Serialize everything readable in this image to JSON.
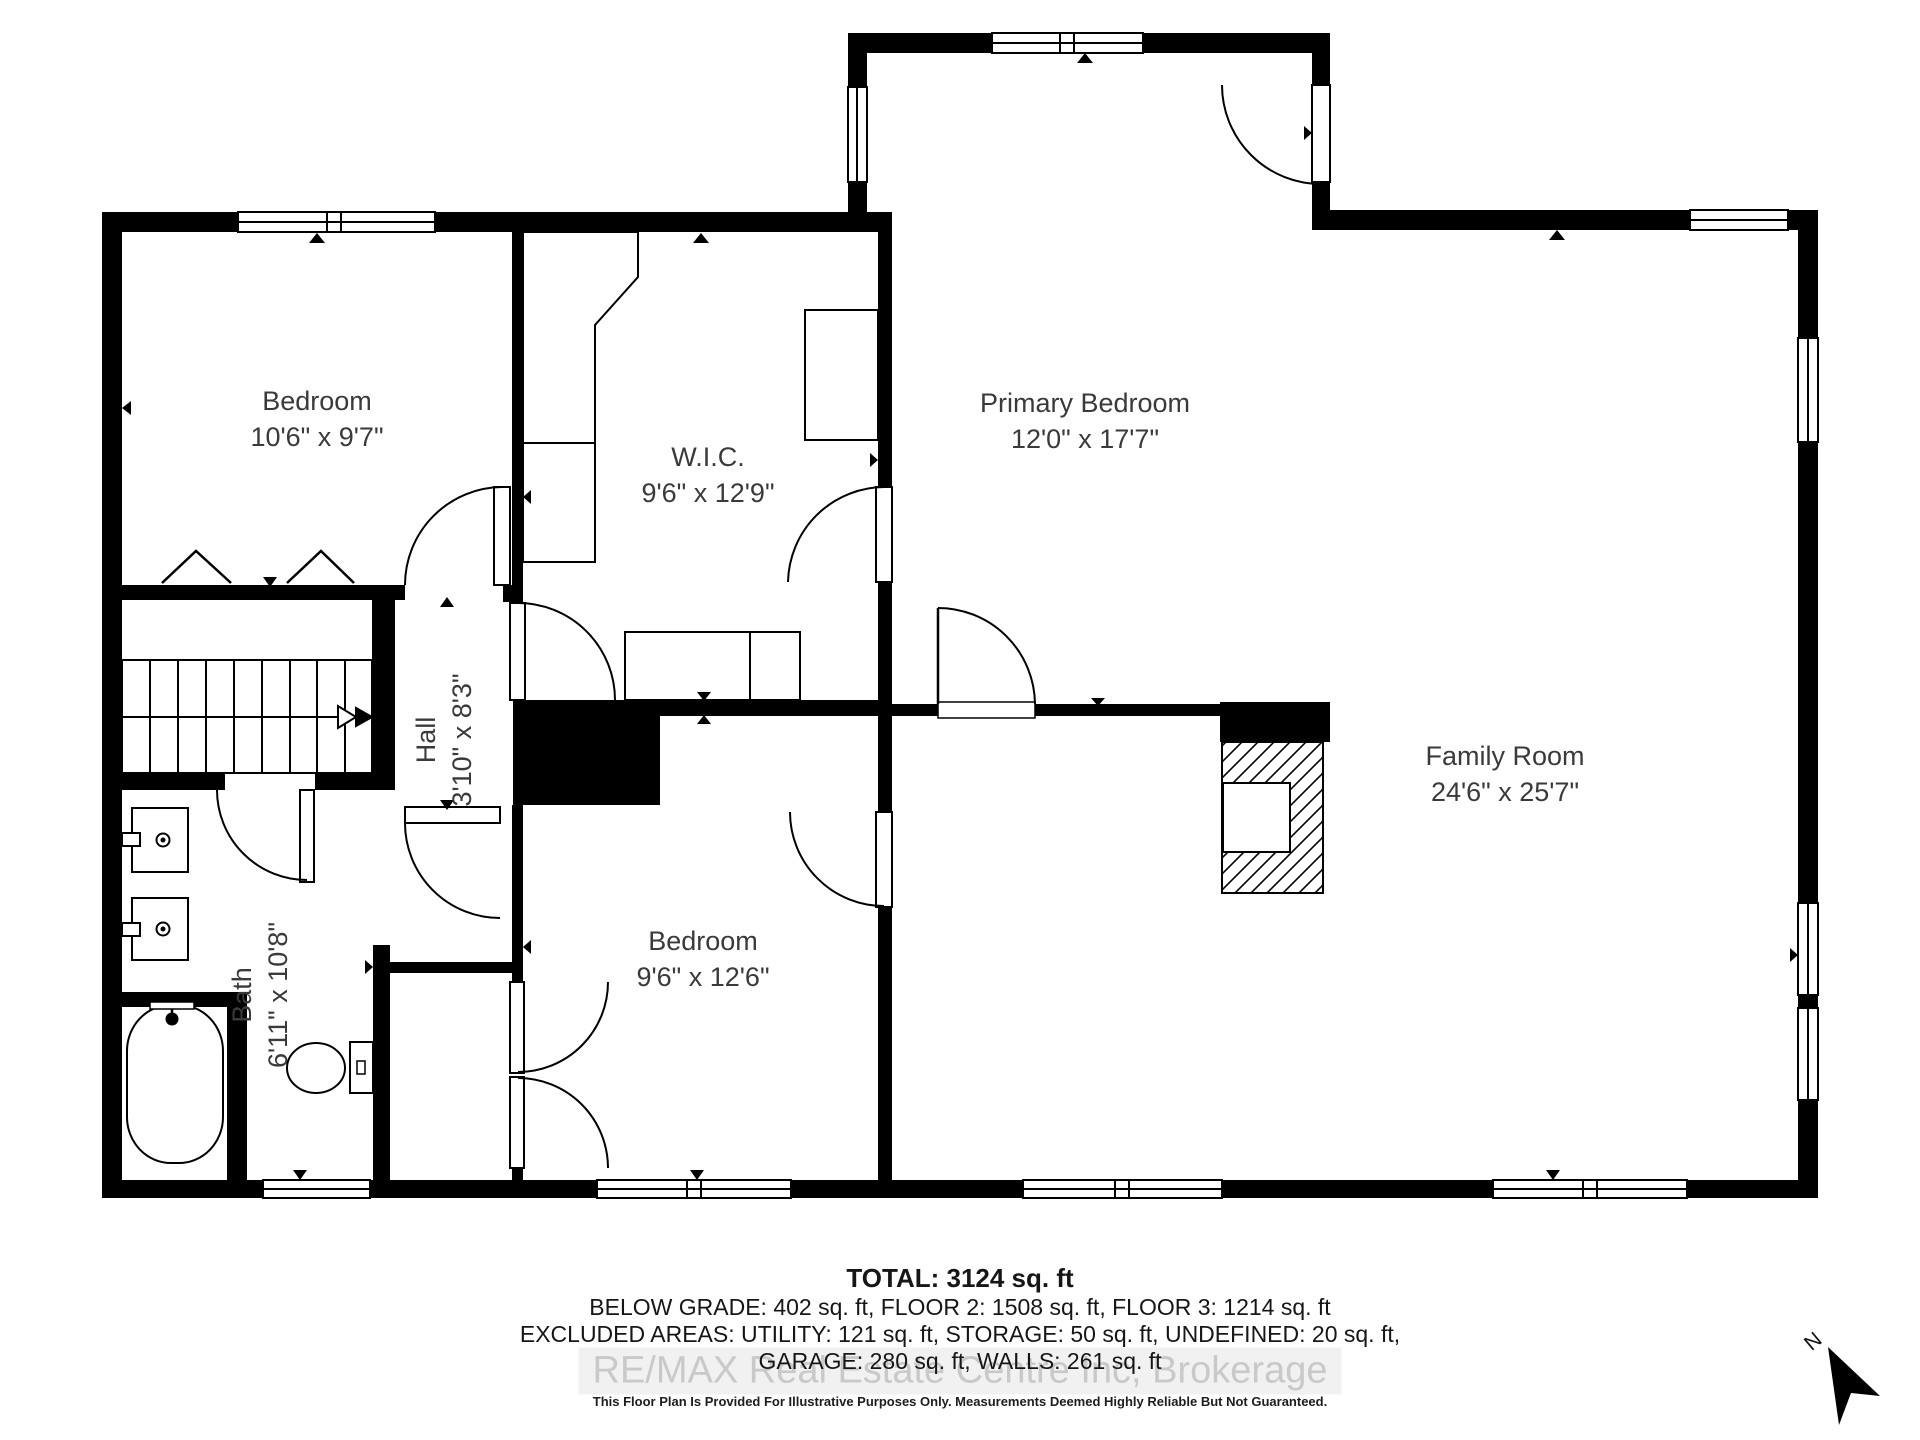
{
  "plan": {
    "rooms": [
      {
        "id": "bedroom-1",
        "name": "Bedroom",
        "dims": "10'6\" x 9'7\""
      },
      {
        "id": "wic",
        "name": "W.I.C.",
        "dims": "9'6\" x 12'9\""
      },
      {
        "id": "primary-bedroom",
        "name": "Primary Bedroom",
        "dims": "12'0\" x 17'7\""
      },
      {
        "id": "family-room",
        "name": "Family Room",
        "dims": "24'6\" x 25'7\""
      },
      {
        "id": "bedroom-2",
        "name": "Bedroom",
        "dims": "9'6\" x 12'6\""
      },
      {
        "id": "hall",
        "name": "Hall",
        "dims": "3'10\" x 8'3\""
      },
      {
        "id": "bath",
        "name": "Bath",
        "dims": "6'11\" x 10'8\""
      }
    ],
    "north_label": "N"
  },
  "summary": {
    "total": "TOTAL: 3124 sq. ft",
    "line2": "BELOW GRADE: 402 sq. ft, FLOOR 2: 1508 sq. ft, FLOOR 3: 1214 sq. ft",
    "line3": "EXCLUDED AREAS: UTILITY: 121 sq. ft, STORAGE: 50 sq. ft, UNDEFINED: 20 sq. ft,",
    "line4": "GARAGE: 280 sq. ft, WALLS: 261 sq. ft"
  },
  "watermark": "RE/MAX Real Estate Centre Inc, Brokerage",
  "disclaimer": "This Floor Plan Is Provided For Illustrative Purposes Only. Measurements Deemed Highly Reliable But Not Guaranteed.",
  "colors": {
    "wall": "#000000",
    "label_text": "#3a3a3a",
    "watermark_text": "#c9c9c9"
  }
}
